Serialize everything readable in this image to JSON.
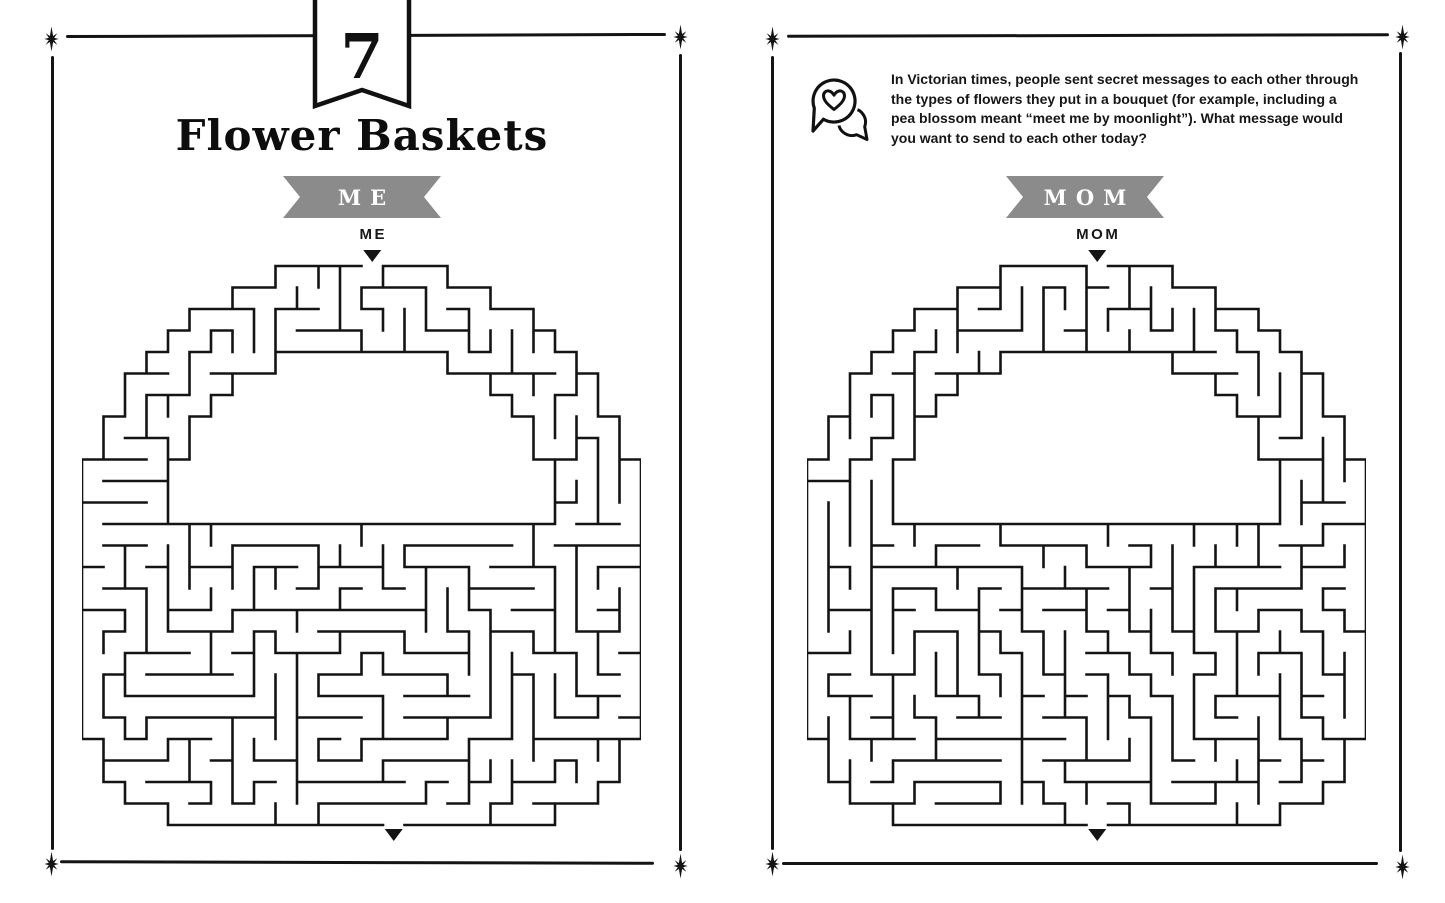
{
  "left_page": {
    "chapter_number": "7",
    "title": "Flower Baskets",
    "banner_label": "ME",
    "start_label": "ME"
  },
  "right_page": {
    "intro_lines": [
      "In Victorian times, people sent secret messages to each other through",
      "the types of flowers they put in a bouquet (for example, including a",
      "pea blossom meant “meet me by moonlight”). What message would",
      "you want to send to each other today?"
    ],
    "banner_label": "MOM",
    "start_label": "MOM"
  },
  "colors": {
    "ink": "#141414",
    "paper": "#ffffff",
    "banner_gray": "#8b8b8b"
  },
  "mazes": {
    "left": {
      "cols": 26,
      "rows": 26,
      "cell": 21.5,
      "outer_radius": 13.0,
      "inner_radius": 9.4,
      "rim_row": 12,
      "bottom_exponent": 4.5,
      "entry_col": 13,
      "exit_col": 14,
      "seed": 7131
    },
    "right": {
      "cols": 26,
      "rows": 26,
      "cell": 21.5,
      "outer_radius": 13.0,
      "inner_radius": 9.4,
      "rim_row": 12,
      "bottom_exponent": 4.5,
      "entry_col": 13,
      "exit_col": 13,
      "seed": 41719
    }
  }
}
